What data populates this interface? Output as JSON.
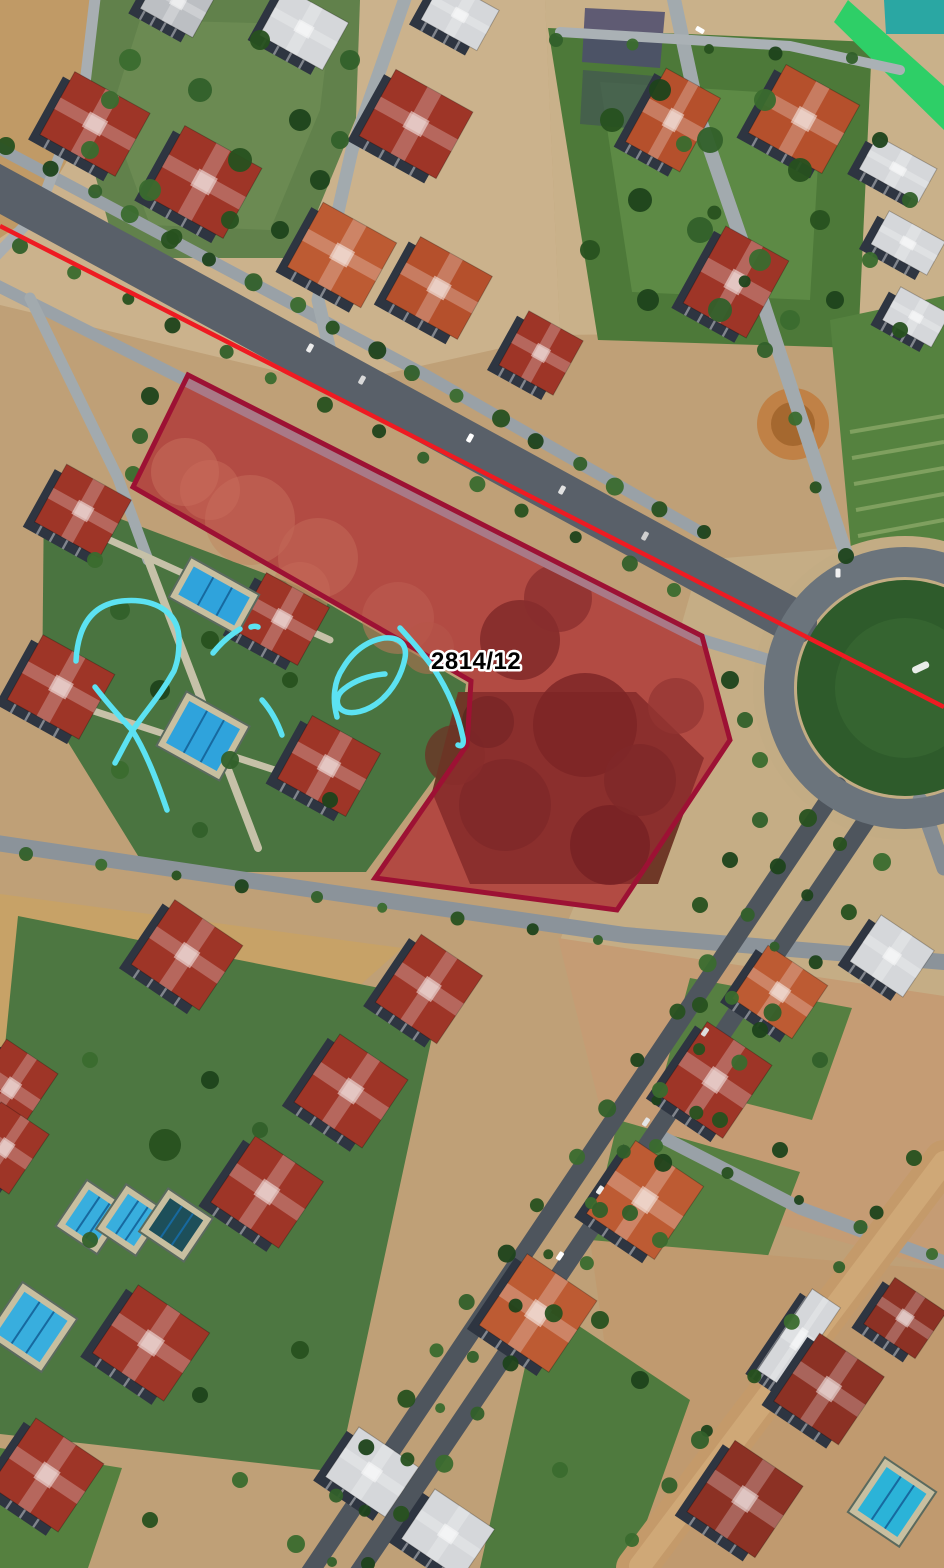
{
  "annotation": {
    "parcel": {
      "label": "2814/12",
      "points": "188,375 133,487 471,681 467,745 375,878 617,910 730,740 702,636",
      "stroke": "#9d1134",
      "stroke_width": 5,
      "fill": "rgba(206,28,60,0.30)",
      "label_x": 431,
      "label_y": 669,
      "label_size": 24,
      "label_color": "#000000",
      "label_halo": "#ffffff"
    },
    "red_line": {
      "x1": 0,
      "y1": 226,
      "x2": 944,
      "y2": 707,
      "color": "#ee1b22",
      "width": 4.5
    },
    "scribbles": {
      "color": "#5ce2f2",
      "width": 5.5,
      "paths": [
        "M 76,661 C 78,622 95,604 122,601 C 152,598 179,610 179,640 C 179,656 177,663 174,671 C 160,696 145,712 133,730 C 127,740 121,752 115,763",
        "M 95,687 C 105,700 119,716 132,730 C 146,752 157,781 167,810",
        "M 213,653 C 221,643 230,635 240,629",
        "M 251,627 C 254,626 256,626 258,627",
        "M 262,700 C 270,709 277,721 282,735",
        "M 337,717 C 332,699 334,681 343,668 C 354,649 373,637 390,638 C 402,639 407,647 405,658 C 402,674 393,690 380,701 C 368,711 351,716 342,710 C 335,705 336,695 344,689 C 354,681 369,675 385,674",
        "M 400,628 C 412,641 424,655 434,669 C 448,690 458,714 463,738 C 464,744 462,747 458,745"
      ]
    }
  },
  "scene": {
    "bg": "#bfa077",
    "facade": "#2e3541",
    "patches": [
      {
        "p": "0,0 545,0 560,335 335,385 0,305",
        "c": "#cbb28c"
      },
      {
        "p": "0,0 100,0 92,118 36,214 0,238",
        "c": "#c09a66"
      },
      {
        "p": "100,0 360,0 356,118 298,258 118,258 80,120",
        "c": "#61814b"
      },
      {
        "p": "140,20 330,25 320,110 270,230 150,225 110,115",
        "c": "#6f8f55",
        "o": 0.7
      },
      {
        "p": "545,0 944,0 944,330 560,335",
        "c": "#c9b18a"
      },
      {
        "p": "548,28 872,42 858,348 598,340",
        "c": "#4d7939"
      },
      {
        "p": "600,82 822,96 810,300 632,292",
        "c": "#5d8a45"
      },
      {
        "p": "585,8 665,12 660,68 582,62",
        "c": "#4c4c6e",
        "o": 0.85
      },
      {
        "p": "583,70 655,76 650,130 580,124",
        "c": "#445a50",
        "o": 0.8
      },
      {
        "p": "848,0 944,86 944,130 834,22",
        "c": "#2ecf67"
      },
      {
        "p": "884,0 944,0 944,34 886,34",
        "c": "#2aa7a3"
      },
      {
        "p": "700,560 944,540 944,1000 560,940 660,700",
        "c": "#c5ad85"
      },
      {
        "p": "830,320 944,296 944,560 852,560",
        "c": "#55823f"
      },
      {
        "p": "0,894 402,948 330,1012 0,1058",
        "c": "#c7a267"
      },
      {
        "p": "44,490 298,586 466,684 458,746 366,872 148,872 42,700",
        "c": "#4a7440"
      },
      {
        "p": "18,916 440,1000 338,1472 0,1434 0,1096",
        "c": "#4d7741"
      },
      {
        "p": "0,1448 122,1468 88,1568 0,1568",
        "c": "#55803f"
      },
      {
        "p": "558,938 944,996 944,1270 618,1180",
        "c": "#c59c74"
      },
      {
        "p": "690,978 852,1008 812,1120 662,1082",
        "c": "#567f41"
      },
      {
        "p": "618,1120 800,1172 758,1282 590,1240",
        "c": "#567f41"
      },
      {
        "p": "590,1240 944,1270 944,1568 636,1568",
        "c": "#c09a6f"
      },
      {
        "p": "540,1300 690,1400 630,1568 480,1568",
        "c": "#4f7a3e"
      },
      {
        "p": "188,375 133,487 471,681 467,745 375,878 617,910 730,740 702,636",
        "c": "#a66047"
      },
      {
        "p": "458,692 636,692 704,758 658,884 470,884 432,792",
        "c": "#6f3827"
      }
    ],
    "circles": [
      [
        905,
        688,
        152,
        "#c3ac84"
      ],
      [
        793,
        424,
        36,
        "#c08146"
      ],
      [
        793,
        424,
        22,
        "#a5682f"
      ],
      [
        520,
        640,
        40,
        "#5e2e21",
        0.8
      ],
      [
        585,
        725,
        52,
        "#59291d",
        0.8
      ],
      [
        505,
        805,
        46,
        "#5e2e21",
        0.8
      ],
      [
        610,
        845,
        40,
        "#51241a",
        0.8
      ],
      [
        455,
        755,
        30,
        "#6a3526",
        0.8
      ],
      [
        558,
        598,
        34,
        "#6a3526",
        0.7
      ],
      [
        640,
        780,
        36,
        "#5e2e21",
        0.8
      ],
      [
        676,
        706,
        28,
        "#7a422f",
        0.7
      ],
      [
        488,
        722,
        26,
        "#542a1e",
        0.8
      ],
      [
        250,
        520,
        45,
        "#c08a64",
        0.6
      ],
      [
        318,
        558,
        40,
        "#bd8760",
        0.6
      ],
      [
        185,
        472,
        34,
        "#c38d66",
        0.6
      ],
      [
        398,
        618,
        36,
        "#b5795a",
        0.6
      ],
      [
        300,
        592,
        30,
        "#c08a64",
        0.6
      ],
      [
        428,
        648,
        26,
        "#ad6f50",
        0.6
      ],
      [
        210,
        490,
        30,
        "#c79067",
        0.5
      ]
    ],
    "roads": [
      {
        "d": "M -20,138 L 420,372 L 700,532",
        "w": 12,
        "c": "#99a1a7"
      },
      {
        "d": "M -10,282 L 702,640 L 782,664",
        "w": 12,
        "c": "#9aa2a8"
      },
      {
        "d": "M 408,-10 L 352,150 L 318,300 L 336,376",
        "w": 13,
        "c": "#a2aaae"
      },
      {
        "d": "M 96,-10 L 84,92 L 38,212 L -10,262",
        "w": 11,
        "c": "#a8aeb2"
      },
      {
        "d": "M 30,298 L 118,478 L 148,560",
        "w": 11,
        "c": "#a2aaae"
      },
      {
        "d": "M 148,560 L 258,848",
        "w": 8,
        "c": "#c6c1a8"
      },
      {
        "d": "M 60,700 L 330,788",
        "w": 7,
        "c": "#c6c1a8"
      },
      {
        "d": "M 92,532 L 330,640",
        "w": 7,
        "c": "#c6c1a8"
      },
      {
        "d": "M 672,-10 L 700,120 L 762,300 L 812,452 L 848,560",
        "w": 14,
        "c": "#a2aaae"
      },
      {
        "d": "M 560,32 L 790,46 L 900,70",
        "w": 10,
        "c": "#aab1b5"
      },
      {
        "d": "M -10,842 L 300,888 L 625,935 L 944,962",
        "w": 16,
        "c": "#8b939a"
      },
      {
        "d": "M 660,1136 L 800,1208 L 944,1262",
        "w": 13,
        "c": "#99a1a7"
      },
      {
        "d": "M 920,800 L 944,868",
        "w": 15,
        "c": "#848c93"
      },
      {
        "d": "M 944,1160 L 636,1568",
        "w": 40,
        "c": "#c49a6a"
      },
      {
        "d": "M 944,1162 L 640,1566",
        "w": 22,
        "c": "#cfa877"
      },
      {
        "d": "M -20,178 L 795,622",
        "w": 44,
        "c": "#596069"
      },
      {
        "d": "M 838,786 L 306,1578",
        "w": 18,
        "c": "#4e555d"
      },
      {
        "d": "M 872,812 L 348,1588",
        "w": 18,
        "c": "#4e555d"
      }
    ],
    "stripes": [
      [
        850,
        432,
        944,
        416
      ],
      [
        852,
        458,
        944,
        442
      ],
      [
        854,
        484,
        944,
        468
      ],
      [
        856,
        510,
        944,
        494
      ],
      [
        858,
        536,
        944,
        520
      ]
    ],
    "stripe_color": "#7fa05f",
    "roundabout": {
      "cx": 905,
      "cy": 688,
      "ring_r": 126,
      "ring_w": 30,
      "ring_c": "#6b747c",
      "green_r": 108,
      "green_c": "#2e5b2b",
      "inner_r": 70,
      "inner_c": "#3a6b33",
      "mark_c": "#e9ede9"
    },
    "roof_colors": {
      "red": "#9e3527",
      "orange": "#b5502c",
      "orange2": "#bd5b33",
      "darkred": "#8c3124",
      "white": "#d5d7da",
      "gray": "#bcbfc3"
    },
    "buildings": [
      {
        "x": 52,
        "y": 88,
        "w": 86,
        "h": 72,
        "r": 29,
        "c": "red"
      },
      {
        "x": 160,
        "y": 142,
        "w": 88,
        "h": 80,
        "r": 29,
        "c": "red"
      },
      {
        "x": 268,
        "y": 2,
        "w": 72,
        "h": 54,
        "r": 29,
        "c": "white"
      },
      {
        "x": 372,
        "y": 86,
        "w": 88,
        "h": 76,
        "r": 29,
        "c": "red"
      },
      {
        "x": 428,
        "y": -8,
        "w": 64,
        "h": 46,
        "r": 29,
        "c": "white"
      },
      {
        "x": 300,
        "y": 218,
        "w": 84,
        "h": 74,
        "r": 29,
        "c": "orange2"
      },
      {
        "x": 398,
        "y": 252,
        "w": 82,
        "h": 72,
        "r": 29,
        "c": "orange"
      },
      {
        "x": 148,
        "y": -22,
        "w": 60,
        "h": 48,
        "r": 29,
        "c": "gray"
      },
      {
        "x": 642,
        "y": 78,
        "w": 62,
        "h": 84,
        "r": 29,
        "c": "orange"
      },
      {
        "x": 762,
        "y": 80,
        "w": 84,
        "h": 78,
        "r": 29,
        "c": "orange"
      },
      {
        "x": 700,
        "y": 238,
        "w": 72,
        "h": 88,
        "r": 29,
        "c": "red"
      },
      {
        "x": 510,
        "y": 322,
        "w": 62,
        "h": 62,
        "r": 29,
        "c": "red"
      },
      {
        "x": 864,
        "y": 150,
        "w": 68,
        "h": 38,
        "r": 29,
        "c": "white"
      },
      {
        "x": 876,
        "y": 224,
        "w": 64,
        "h": 38,
        "r": 29,
        "c": "white"
      },
      {
        "x": 888,
        "y": 298,
        "w": 56,
        "h": 38,
        "r": 29,
        "c": "white"
      },
      {
        "x": 46,
        "y": 478,
        "w": 74,
        "h": 66,
        "r": 29,
        "c": "red"
      },
      {
        "x": 20,
        "y": 650,
        "w": 82,
        "h": 74,
        "r": 29,
        "c": "red"
      },
      {
        "x": 246,
        "y": 586,
        "w": 72,
        "h": 66,
        "r": 29,
        "c": "red"
      },
      {
        "x": 290,
        "y": 730,
        "w": 78,
        "h": 72,
        "r": 29,
        "c": "red"
      },
      {
        "x": 146,
        "y": 916,
        "w": 82,
        "h": 78,
        "r": 34,
        "c": "red"
      },
      {
        "x": 392,
        "y": 948,
        "w": 74,
        "h": 82,
        "r": 34,
        "c": "red"
      },
      {
        "x": 310,
        "y": 1050,
        "w": 82,
        "h": 82,
        "r": 34,
        "c": "red"
      },
      {
        "x": 226,
        "y": 1152,
        "w": 82,
        "h": 80,
        "r": 34,
        "c": "red"
      },
      {
        "x": -20,
        "y": 1050,
        "w": 62,
        "h": 76,
        "r": 34,
        "c": "red"
      },
      {
        "x": -24,
        "y": 1112,
        "w": 58,
        "h": 72,
        "r": 34,
        "c": "red"
      },
      {
        "x": 108,
        "y": 1302,
        "w": 86,
        "h": 82,
        "r": 34,
        "c": "red"
      },
      {
        "x": 6,
        "y": 1434,
        "w": 82,
        "h": 82,
        "r": 34,
        "c": "red"
      },
      {
        "x": 336,
        "y": 1442,
        "w": 72,
        "h": 60,
        "r": 34,
        "c": "white"
      },
      {
        "x": 412,
        "y": 1504,
        "w": 72,
        "h": 60,
        "r": 34,
        "c": "white"
      },
      {
        "x": 744,
        "y": 960,
        "w": 72,
        "h": 64,
        "r": 34,
        "c": "orange2"
      },
      {
        "x": 676,
        "y": 1036,
        "w": 78,
        "h": 88,
        "r": 34,
        "c": "red"
      },
      {
        "x": 604,
        "y": 1156,
        "w": 82,
        "h": 88,
        "r": 34,
        "c": "orange2"
      },
      {
        "x": 496,
        "y": 1270,
        "w": 84,
        "h": 86,
        "r": 34,
        "c": "orange2"
      },
      {
        "x": 860,
        "y": 928,
        "w": 64,
        "h": 56,
        "r": 34,
        "c": "white"
      },
      {
        "x": 782,
        "y": 1290,
        "w": 34,
        "h": 98,
        "r": 34,
        "c": "white"
      },
      {
        "x": 790,
        "y": 1348,
        "w": 78,
        "h": 82,
        "r": 34,
        "c": "darkred"
      },
      {
        "x": 704,
        "y": 1456,
        "w": 82,
        "h": 86,
        "r": 34,
        "c": "darkred"
      },
      {
        "x": 874,
        "y": 1290,
        "w": 62,
        "h": 56,
        "r": 34,
        "c": "darkred"
      }
    ],
    "pools": [
      {
        "x": 182,
        "y": 580,
        "w": 64,
        "h": 32,
        "r": 29,
        "c": "#2fa3dc"
      },
      {
        "x": 174,
        "y": 712,
        "w": 58,
        "h": 48,
        "r": 29,
        "c": "#2fa3dc"
      },
      {
        "x": 74,
        "y": 1196,
        "w": 36,
        "h": 42,
        "r": 34,
        "c": "#38aede"
      },
      {
        "x": 114,
        "y": 1200,
        "w": 34,
        "h": 40,
        "r": 34,
        "c": "#38aede"
      },
      {
        "x": 156,
        "y": 1206,
        "w": 40,
        "h": 38,
        "r": 34,
        "c": "#1d4f5a"
      },
      {
        "x": 6,
        "y": 1302,
        "w": 52,
        "h": 50,
        "r": 34,
        "c": "#38aede"
      },
      {
        "x": 868,
        "y": 1476,
        "w": 48,
        "h": 52,
        "r": 34,
        "c": "#2bb3d8"
      }
    ],
    "tree_rows": [
      {
        "a": [
          10,
          150
        ],
        "b": [
          700,
          536
        ],
        "s": 46,
        "r": 9
      },
      {
        "a": [
          24,
          250
        ],
        "b": [
          676,
          594
        ],
        "s": 54,
        "r": 8
      },
      {
        "a": [
          812,
          822
        ],
        "b": [
          300,
          1548
        ],
        "s": 58,
        "r": 9
      },
      {
        "a": [
          844,
          848
        ],
        "b": [
          330,
          1566
        ],
        "s": 60,
        "r": 7
      },
      {
        "a": [
          886,
          866
        ],
        "b": [
          366,
          1568
        ],
        "s": 62,
        "r": 9
      },
      {
        "a": [
          30,
          858
        ],
        "b": [
          600,
          944
        ],
        "s": 72,
        "r": 7
      },
      {
        "a": [
          688,
          148
        ],
        "b": [
          846,
          560
        ],
        "s": 70,
        "r": 8
      },
      {
        "a": [
          560,
          44
        ],
        "b": [
          850,
          62
        ],
        "s": 64,
        "r": 7
      },
      {
        "a": [
          660,
          1150
        ],
        "b": [
          930,
          1258
        ],
        "s": 64,
        "r": 7
      },
      {
        "a": [
          918,
          1162
        ],
        "b": [
          628,
          1544
        ],
        "s": 66,
        "r": 8
      }
    ],
    "trees": [
      [
        612,
        120,
        12
      ],
      [
        660,
        90,
        11
      ],
      [
        710,
        140,
        13
      ],
      [
        765,
        100,
        11
      ],
      [
        800,
        170,
        12
      ],
      [
        640,
        200,
        12
      ],
      [
        700,
        230,
        13
      ],
      [
        760,
        260,
        11
      ],
      [
        820,
        220,
        10
      ],
      [
        648,
        300,
        11
      ],
      [
        720,
        310,
        12
      ],
      [
        790,
        320,
        10
      ],
      [
        590,
        250,
        10
      ],
      [
        835,
        300,
        9
      ],
      [
        120,
        610,
        10
      ],
      [
        95,
        560,
        8
      ],
      [
        210,
        640,
        9
      ],
      [
        160,
        690,
        10
      ],
      [
        230,
        760,
        9
      ],
      [
        120,
        770,
        9
      ],
      [
        290,
        680,
        8
      ],
      [
        330,
        800,
        8
      ],
      [
        200,
        830,
        8
      ],
      [
        150,
        190,
        11
      ],
      [
        240,
        160,
        12
      ],
      [
        300,
        120,
        11
      ],
      [
        200,
        90,
        12
      ],
      [
        130,
        60,
        11
      ],
      [
        260,
        40,
        10
      ],
      [
        320,
        180,
        10
      ],
      [
        350,
        60,
        10
      ],
      [
        90,
        150,
        9
      ],
      [
        170,
        240,
        9
      ],
      [
        280,
        230,
        9
      ],
      [
        340,
        140,
        9
      ],
      [
        110,
        100,
        9
      ],
      [
        230,
        220,
        9
      ],
      [
        150,
        396,
        9
      ],
      [
        140,
        436,
        8
      ],
      [
        133,
        474,
        8
      ],
      [
        700,
        1005,
        8
      ],
      [
        760,
        1030,
        8
      ],
      [
        820,
        1060,
        8
      ],
      [
        660,
        1090,
        8
      ],
      [
        720,
        1120,
        8
      ],
      [
        780,
        1150,
        8
      ],
      [
        600,
        1210,
        8
      ],
      [
        660,
        1240,
        8
      ],
      [
        600,
        1320,
        9
      ],
      [
        640,
        1380,
        9
      ],
      [
        700,
        1440,
        9
      ],
      [
        560,
        1470,
        8
      ],
      [
        165,
        1145,
        16
      ],
      [
        210,
        1080,
        9
      ],
      [
        260,
        1130,
        8
      ],
      [
        90,
        1060,
        8
      ],
      [
        300,
        1350,
        9
      ],
      [
        200,
        1395,
        8
      ],
      [
        90,
        1240,
        8
      ],
      [
        240,
        1480,
        8
      ],
      [
        150,
        1520,
        8
      ],
      [
        880,
        140,
        8
      ],
      [
        910,
        200,
        8
      ],
      [
        870,
        260,
        8
      ],
      [
        900,
        330,
        8
      ],
      [
        730,
        680,
        9
      ],
      [
        745,
        720,
        8
      ],
      [
        760,
        760,
        8
      ],
      [
        700,
        905,
        8
      ],
      [
        730,
        860,
        8
      ],
      [
        760,
        820,
        8
      ]
    ],
    "tree_colors": [
      "#27511f",
      "#1d431b",
      "#32602a",
      "#3a6b2e"
    ],
    "cars": [
      [
        310,
        348,
        29,
        "#ececec"
      ],
      [
        362,
        380,
        29,
        "#d9d9d9"
      ],
      [
        470,
        438,
        29,
        "#ffffff"
      ],
      [
        562,
        490,
        29,
        "#e2e2e2"
      ],
      [
        645,
        536,
        29,
        "#cfcfcf"
      ],
      [
        700,
        30,
        -60,
        "#ffffff"
      ],
      [
        838,
        573,
        0,
        "#f0f0f0"
      ],
      [
        600,
        1190,
        34,
        "#ececec"
      ],
      [
        560,
        1256,
        34,
        "#ffffff"
      ],
      [
        646,
        1122,
        34,
        "#e4e4e4"
      ],
      [
        705,
        1032,
        34,
        "#dddddd"
      ]
    ]
  }
}
